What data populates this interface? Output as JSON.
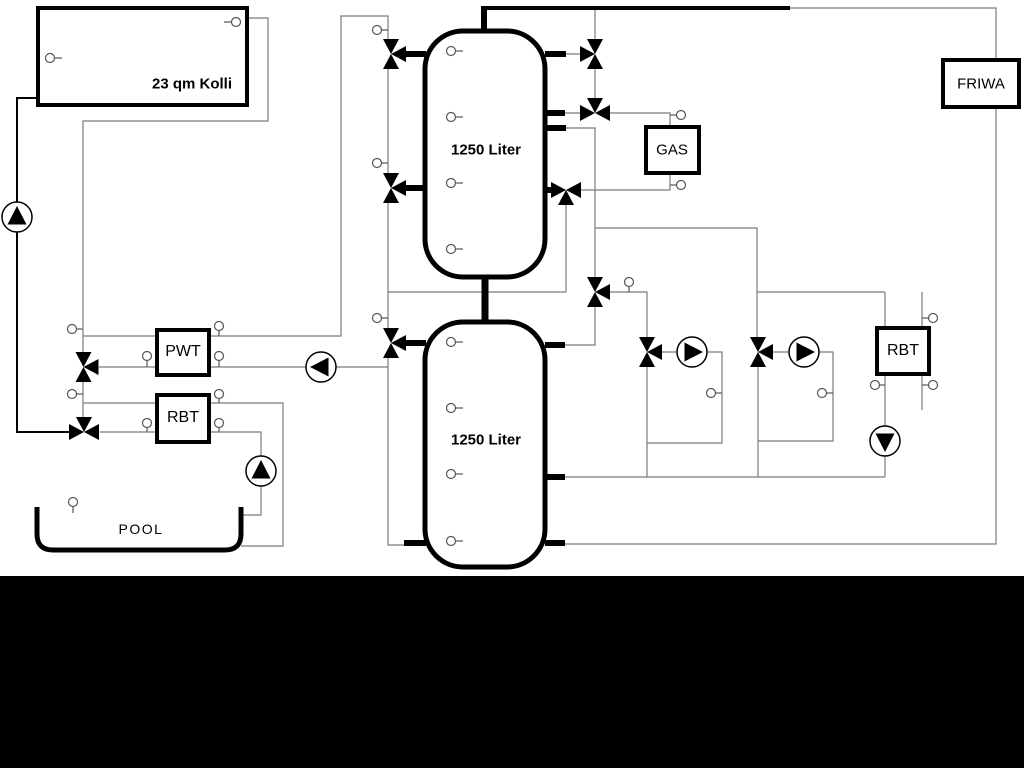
{
  "diagram": {
    "collector": {
      "label": "23 qm Kolli"
    },
    "tank_upper": {
      "label": "1250 Liter"
    },
    "tank_lower": {
      "label": "1250 Liter"
    },
    "gas_boiler": {
      "label": "GAS"
    },
    "friwa": {
      "label": "FRIWA"
    },
    "pwt": {
      "label": "PWT"
    },
    "rbt_left": {
      "label": "RBT"
    },
    "rbt_right": {
      "label": "RBT"
    },
    "pool": {
      "label": "POOL"
    },
    "colors": {
      "pipe_gray": "#7a7a7a",
      "pipe_black": "#000000",
      "background": "#ffffff",
      "bottom_band": "#000000"
    }
  }
}
